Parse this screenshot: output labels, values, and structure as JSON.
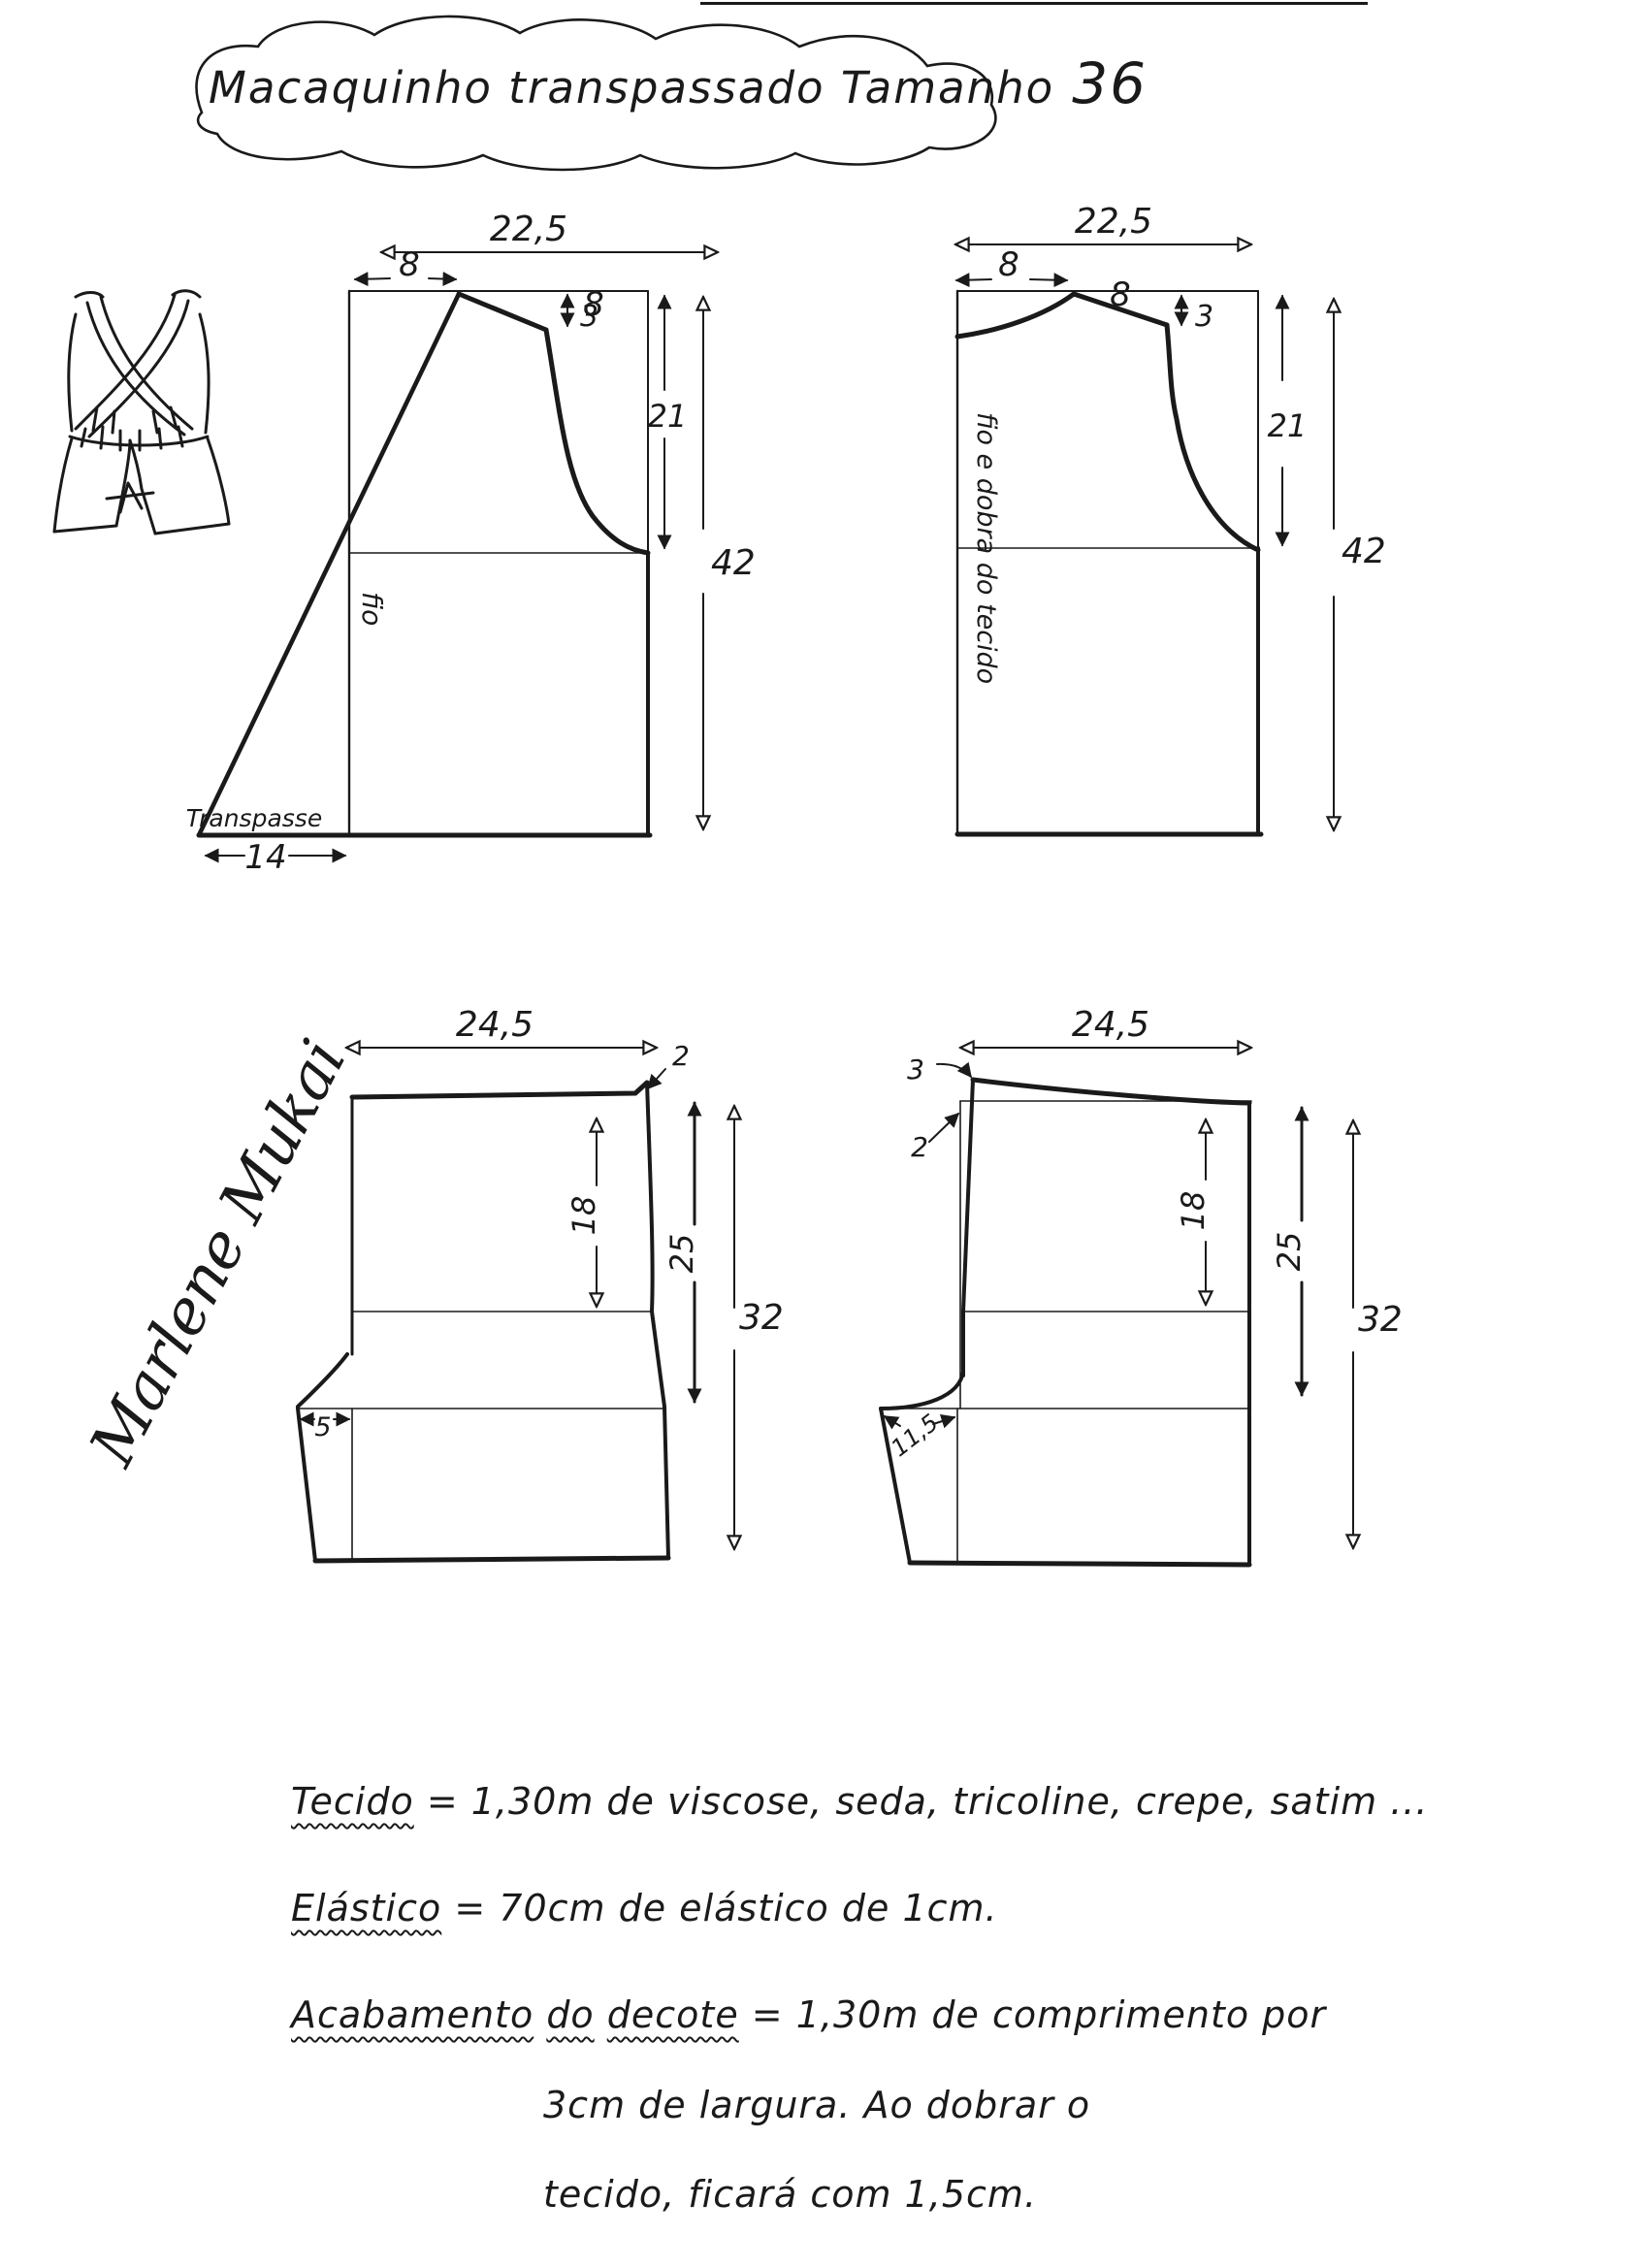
{
  "title": {
    "main": "Macaquinho transpassado Tamanho",
    "size": "36"
  },
  "signature": {
    "text": "Marlene Mukai"
  },
  "pieces": {
    "front_bodice": {
      "width": "22,5",
      "shoulder_width": "8",
      "shoulder_slope": "8",
      "shoulder_drop": "3",
      "armhole_depth": "21",
      "length": "42",
      "overlap_width": "14",
      "grainline": "fio",
      "overlap_label": "Transpasse"
    },
    "back_bodice": {
      "width": "22,5",
      "shoulder_width": "8",
      "shoulder_slope": "8",
      "shoulder_drop": "3",
      "armhole_depth": "21",
      "length": "42",
      "fold_label": "fio e dobra do tecido"
    },
    "shorts_front": {
      "width": "24,5",
      "side_rise": "2",
      "hip_depth": "18",
      "side_length": "25",
      "length": "32",
      "crotch_extension": "5"
    },
    "shorts_back": {
      "width": "24,5",
      "back_rise": "3",
      "side_offset": "2",
      "hip_depth": "18",
      "side_length": "25",
      "length": "32",
      "crotch_extension": "11,5"
    }
  },
  "notes": {
    "line1_label": "Tecido",
    "line1_text": "= 1,30m de  viscose, seda, tricoline, crepe, satim ...",
    "line2_label": "Elástico",
    "line2_text": "=  70cm  de  elástico  de  1cm.",
    "line3_label1": "Acabamento",
    "line3_label2": "do",
    "line3_label3": "decote",
    "line3_text": "= 1,30m  de  comprimento  por",
    "line3_cont1": "3cm  de  largura.  Ao   dobrar  o",
    "line3_cont2": "tecido,  ficará  com   1,5cm."
  }
}
